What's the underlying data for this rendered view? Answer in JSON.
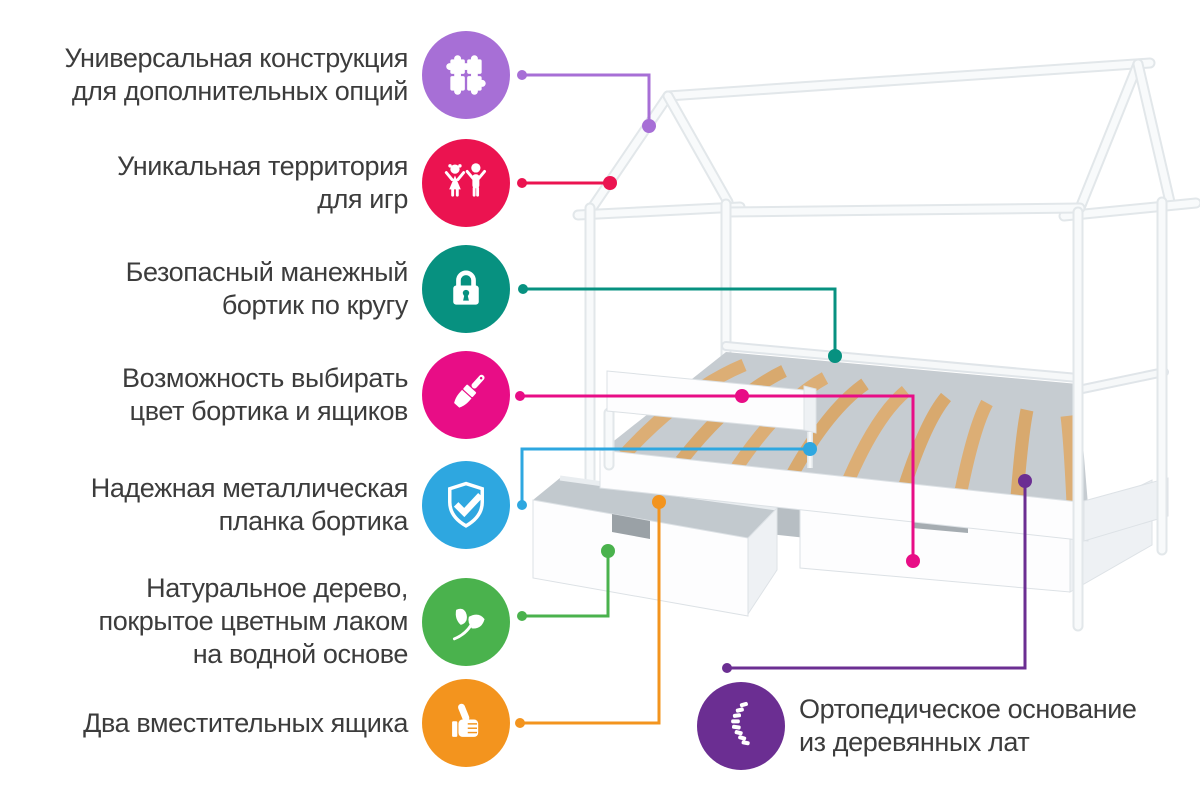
{
  "canvas": {
    "width": 1200,
    "height": 798,
    "background": "#ffffff"
  },
  "illustration": {
    "subject": "Детская кровать-домик с двумя ящиками",
    "description": "white house-frame bed, wood slat base, safety rail, two drawers",
    "frame_color": "#ffffff",
    "outline_color": "#e2e7ea",
    "slat_color": "#dcae75",
    "interior_shadow_color": "#c6ccd1"
  },
  "features": [
    {
      "id": "universal-construction",
      "icon": "puzzle-icon",
      "color": "#a76fd6",
      "lines": [
        "Универсальная конструкция",
        "для дополнительных опций"
      ]
    },
    {
      "id": "play-territory",
      "icon": "children-icon",
      "color": "#eb1350",
      "lines": [
        "Уникальная территория",
        "для игр"
      ]
    },
    {
      "id": "safe-playpen-rail",
      "icon": "padlock-icon",
      "color": "#079180",
      "lines": [
        "Безопасный манежный",
        "бортик по кругу"
      ]
    },
    {
      "id": "color-choice",
      "icon": "paintbrush-icon",
      "color": "#e80d86",
      "lines": [
        "Возможность выбирать",
        "цвет бортика и ящиков"
      ]
    },
    {
      "id": "metal-rail-plank",
      "icon": "shield-check-icon",
      "color": "#2ea7e0",
      "lines": [
        "Надежная металлическая",
        "планка бортика"
      ]
    },
    {
      "id": "natural-wood",
      "icon": "leaf-icon",
      "color": "#4ab24d",
      "lines": [
        "Натуральное дерево,",
        "покрытое цветным лаком",
        "на водной основе"
      ]
    },
    {
      "id": "two-drawers",
      "icon": "thumbs-up-icon",
      "color": "#f3941e",
      "lines": [
        "Два вместительных ящика"
      ]
    },
    {
      "id": "orthopedic-base",
      "icon": "spine-icon",
      "color": "#6b2e92",
      "lines": [
        "Ортопедическое основание",
        "из деревянных лат"
      ]
    }
  ]
}
